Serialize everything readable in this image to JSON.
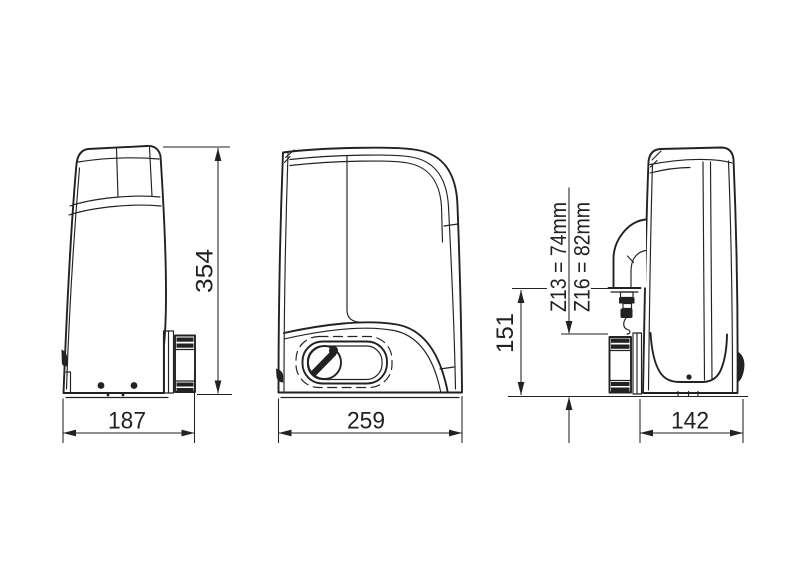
{
  "page": {
    "background": "#ffffff",
    "ink": "#222222"
  },
  "dimensions": {
    "overall_height": "354",
    "left_view_width": "187",
    "front_view_width": "259",
    "right_view_width": "142",
    "conduit_entry_height": "151",
    "pinion_z13_note": "Z13 = 74mm",
    "pinion_z16_note": "Z16 = 82mm"
  }
}
